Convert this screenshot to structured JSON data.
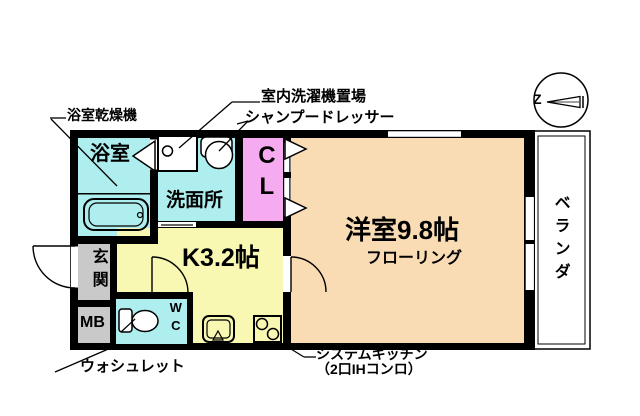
{
  "palette": {
    "wet_area": "#aeeeee",
    "closet": "#f6aaef",
    "kitchen": "#f8f8b2",
    "main_room": "#fadcb4",
    "utility_gray": "#c9c9c9",
    "wall": "#000000",
    "background": "#ffffff"
  },
  "rooms": {
    "bathroom": {
      "label": "浴室"
    },
    "washroom": {
      "label": "洗面所"
    },
    "closet": {
      "label": "CL"
    },
    "kitchen": {
      "label": "K3.2帖"
    },
    "western_room": {
      "label": "洋室9.8帖",
      "sublabel": "フローリング"
    },
    "entrance": {
      "label": "玄関"
    },
    "meter_box": {
      "label": "MB"
    },
    "toilet": {
      "label": "WC"
    },
    "veranda": {
      "label": "ベランダ"
    }
  },
  "annotations": {
    "bath_dryer": "浴室乾燥機",
    "indoor_washer_space": "室内洗濯機置場",
    "shampoo_dresser": "シャンプードレッサー",
    "washlet": "ウォシュレット",
    "system_kitchen": "システムキッチン",
    "system_kitchen_detail": "（2口IHコンロ）"
  },
  "compass": {
    "label": "Z"
  }
}
